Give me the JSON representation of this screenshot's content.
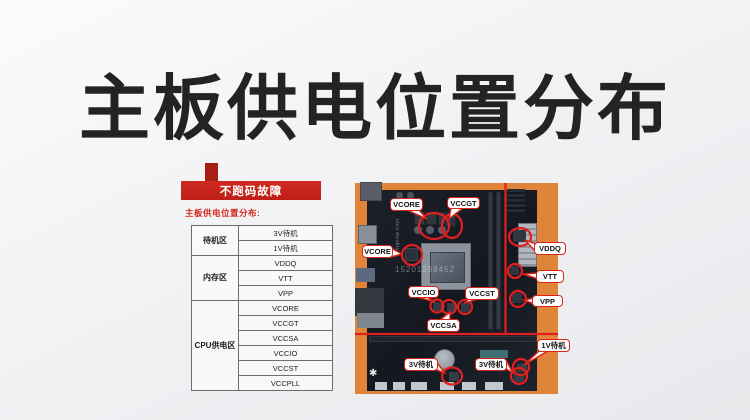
{
  "page": {
    "title": "主板供电位置分布"
  },
  "left_panel": {
    "banner": "不跑码故障",
    "table_title": "主板供电位置分布:",
    "groups": [
      {
        "label": "待机区",
        "items": [
          "3V待机",
          "1V待机"
        ]
      },
      {
        "label": "内存区",
        "items": [
          "VDDQ",
          "VTT",
          "VPP"
        ]
      },
      {
        "label": "CPU供电区",
        "items": [
          "VCORE",
          "VCCGT",
          "VCCSA",
          "VCCIO",
          "VCCST",
          "VCCPLL"
        ]
      }
    ]
  },
  "photo": {
    "watermark": "15201298452",
    "board_print": "ultra durable",
    "callouts": [
      "VCORE",
      "VCCGT",
      "VCORE",
      "VDDQ",
      "VTT",
      "VPP",
      "VCCIO",
      "VCCST",
      "VCCSA",
      "1V待机",
      "3V待机",
      "3V待机"
    ]
  },
  "colors": {
    "banner_red": "#c5221a",
    "annotation_red": "#e02020",
    "photo_background": "#df8438",
    "pcb": "#171b23",
    "title_text": "#232323"
  }
}
